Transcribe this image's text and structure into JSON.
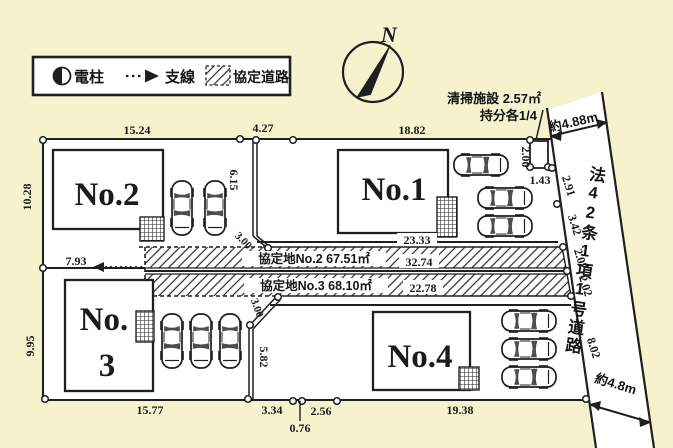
{
  "colors": {
    "background": "#f5f2cd",
    "paper": "#ffffff",
    "ink": "#1f1f1f"
  },
  "legend": {
    "pole": "電柱",
    "guy_wire": "支線",
    "agreement_road": "協定道路"
  },
  "compass": {
    "north": "N"
  },
  "cleaning_facility": {
    "line1": "清掃施設 2.57㎡",
    "line2": "持分各1/4",
    "dim_left": "2.00",
    "dim_bottom": "1.43"
  },
  "road": {
    "name": "法42条1項1号道路",
    "width_top": "約4.88m",
    "width_bottom": "約4.8m",
    "seg1": "2.91",
    "seg2": "3.42",
    "seg3": "2.02",
    "seg4": "2.02",
    "seg5": "8.02"
  },
  "plots": {
    "no1": {
      "label": "No.1"
    },
    "no2": {
      "label": "No.2"
    },
    "no3": {
      "label_line1": "No.",
      "label_line2": "3"
    },
    "no4": {
      "label": "No.4"
    }
  },
  "agreement_strip": {
    "row1": {
      "label": "協定地No.2 67.51㎡",
      "length": "32.74"
    },
    "row2": {
      "label": "協定地No.3 68.10㎡",
      "length": "22.78"
    }
  },
  "dims": {
    "no2_top": "15.24",
    "between_top": "4.27",
    "no1_top": "18.82",
    "no2_left": "10.28",
    "no3_left": "9.95",
    "no1_south": "23.33",
    "no2_offset": "7.93",
    "divider_height": "6.15",
    "cut_no2": "3.00",
    "cut_no3": "3.00",
    "no3_parking_edge": "5.82",
    "no3_bottom": "15.77",
    "bottom_a": "3.34",
    "bottom_b": "0.76",
    "bottom_c": "2.56",
    "no4_bottom": "19.38"
  }
}
